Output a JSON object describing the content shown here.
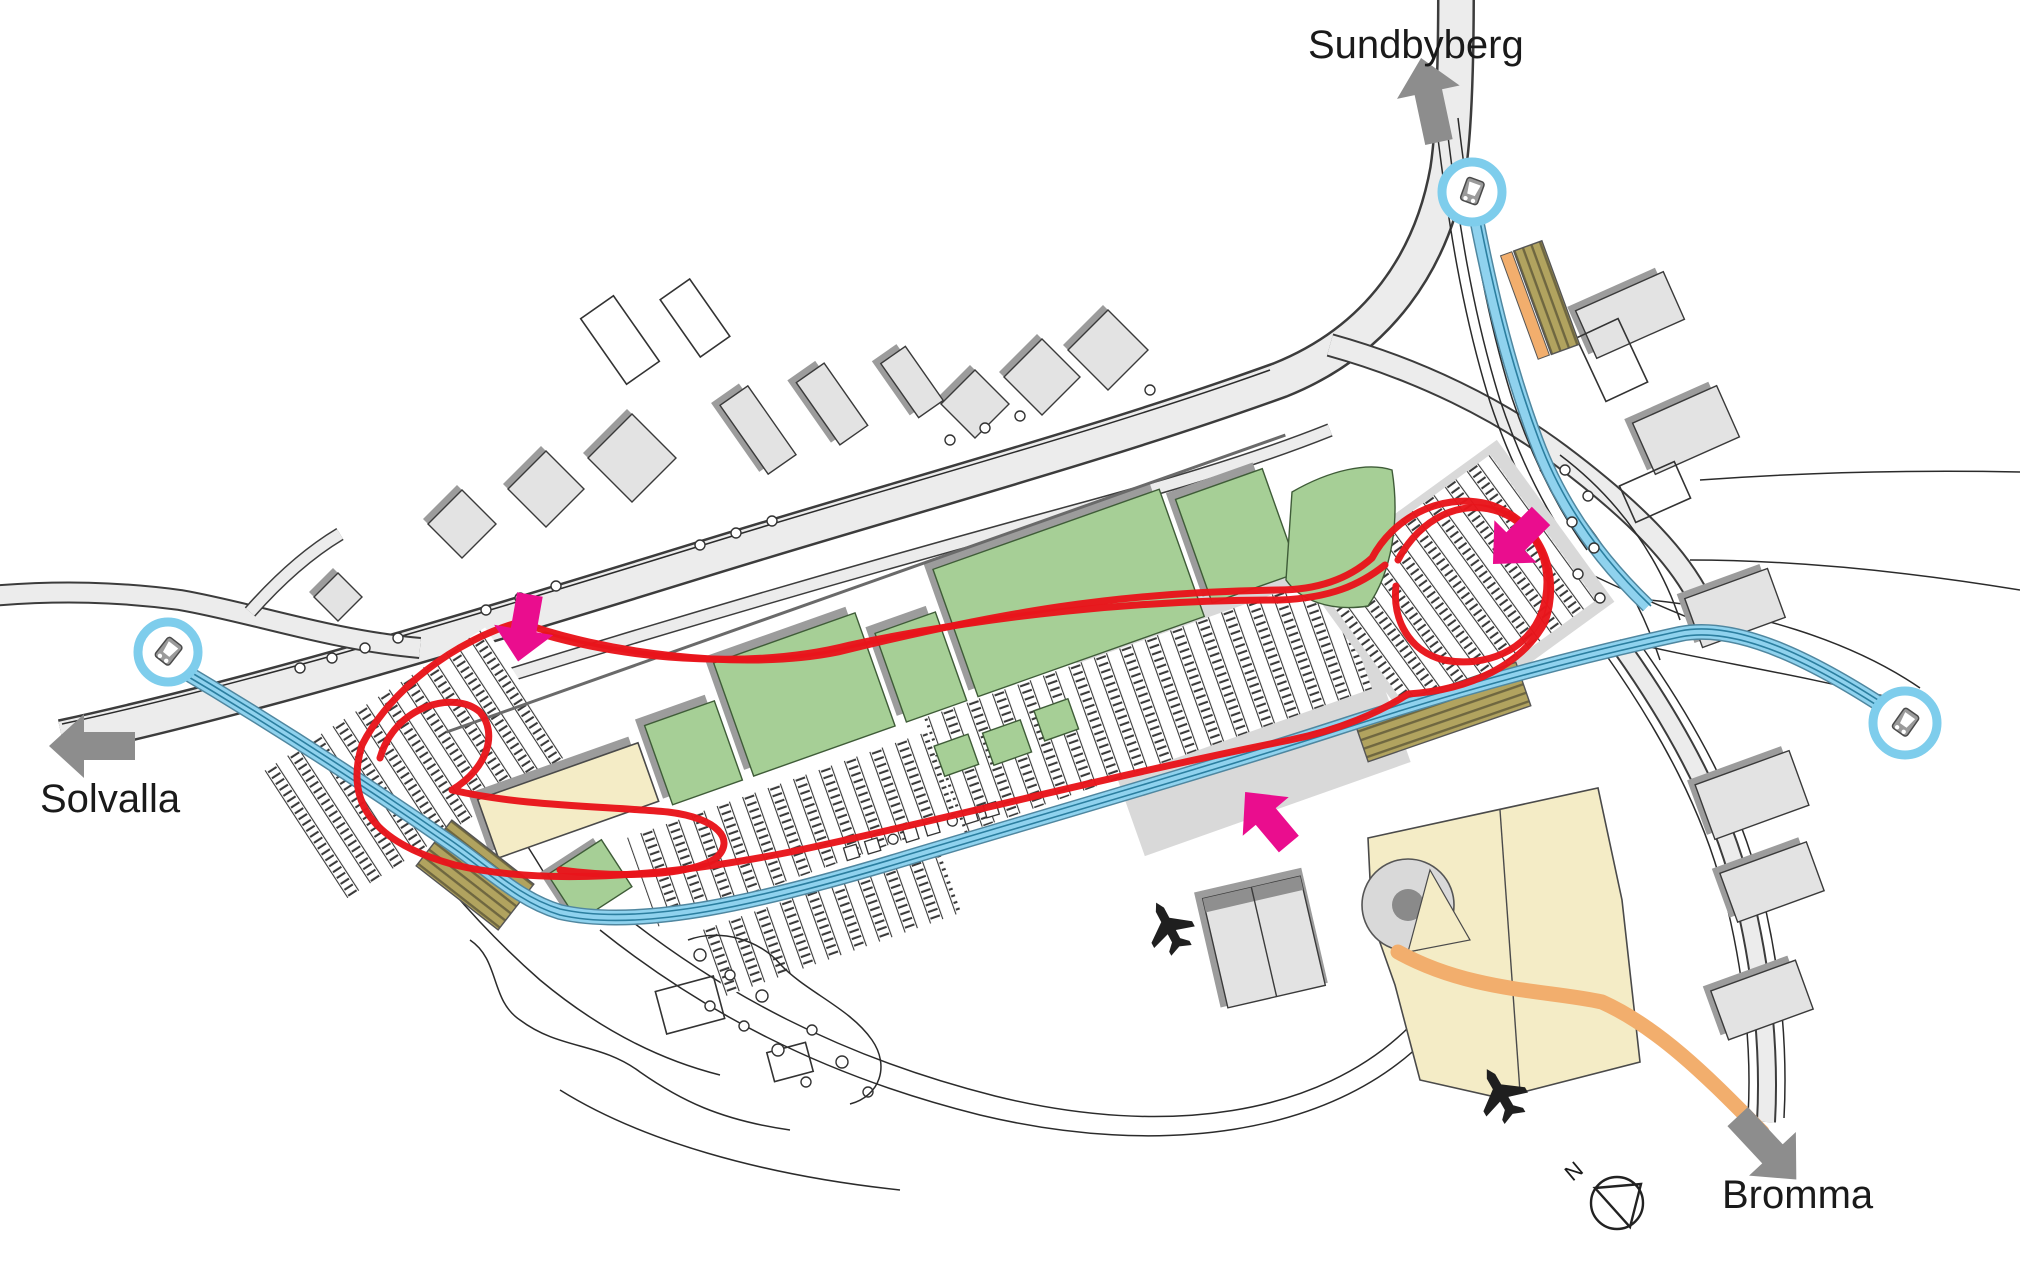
{
  "map": {
    "destination_labels": [
      {
        "id": "sundbyberg",
        "label": "Sundbyberg",
        "arrow_direction": "up"
      },
      {
        "id": "solvalla",
        "label": "Solvalla",
        "arrow_direction": "left"
      },
      {
        "id": "bromma",
        "label": "Bromma",
        "arrow_direction": "down-right"
      }
    ],
    "compass": {
      "label": "N"
    },
    "icons": {
      "bus_stop_icons": 3,
      "airplane_icons": 2,
      "compass_icon": 1
    },
    "annotations": {
      "red_route_loop": "hand-drawn red loop encircling the shopping area and parking",
      "entrance_arrows": 3
    },
    "colors": {
      "route_red": "#e8151b",
      "arrow_pink": "#ea0d8e",
      "arrow_gray": "#8d8d8d",
      "building_green": "#a6cf96",
      "building_beige": "#f4ecc6",
      "building_gray": "#e3e3e3",
      "shadow_gray": "#9c9c9c",
      "road_fill": "#ececec",
      "transit_blue": "#8fd2ee",
      "transit_blue_dark": "#2c7fa0",
      "platform_khaki": "#ac9f5c",
      "path_orange": "#f2ae6d",
      "bus_icon_ring": "#7ecdec",
      "label_color": "#1a1a1a"
    }
  }
}
